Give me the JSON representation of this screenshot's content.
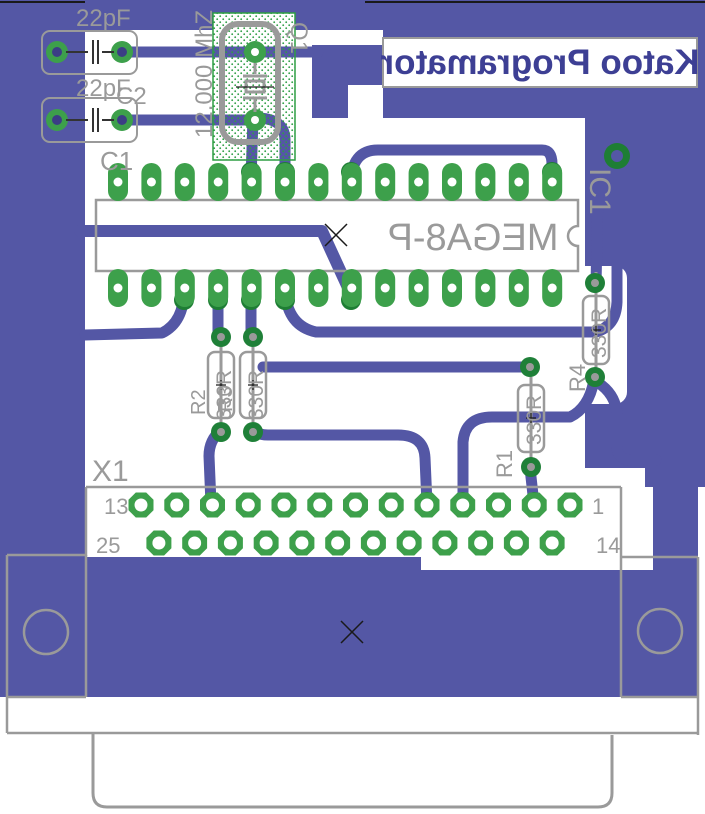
{
  "title": "Katoo Programator",
  "components": {
    "cap1_value": "22pF",
    "cap2_value": "22pF",
    "cap1_ref": "C1",
    "cap2_ref": "C2",
    "crystal_ref": "Q1",
    "crystal_value": "12.000 MhZ",
    "ic_ref": "IC1",
    "ic_value": "MEGA8-P",
    "r1_ref": "R1",
    "r2_ref": "R2",
    "r3_ref": "R3",
    "r4_ref": "R4",
    "r1_value": "330R",
    "r2_value": "330R",
    "r3_value": "330R",
    "r4_value": "330R"
  },
  "connector": {
    "ref": "X1",
    "pin_top_left": "13",
    "pin_bottom_left": "25",
    "pin_top_right": "1",
    "pin_bottom_right": "14"
  },
  "colors": {
    "copper_pour": "#5457a5",
    "pad_green": "#3da04b",
    "pad_dark_green": "#1e7e34",
    "silkscreen_gray": "#9a9a9a",
    "title_text": "#3d3f94",
    "keepout_green": "#2e9e44"
  }
}
